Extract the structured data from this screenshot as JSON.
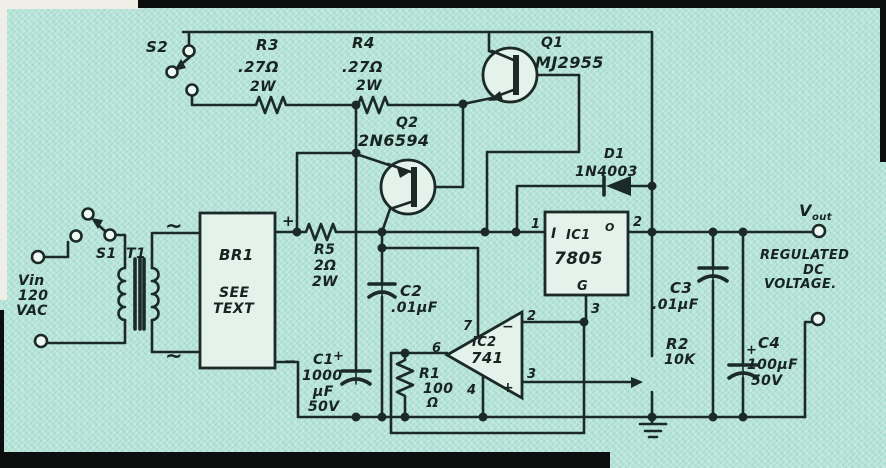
{
  "figure": {
    "type": "schematic",
    "description": "Adjustable regulated DC power supply circuit (scanned hand-drawn schematic)"
  },
  "colors": {
    "paper": "#b3e2d6",
    "ink": "#1b2a27",
    "part_fill": "#e4f2ec"
  },
  "components": {
    "s1": {
      "ref": "S1"
    },
    "s2": {
      "ref": "S2"
    },
    "t1": {
      "ref": "T1"
    },
    "br1": {
      "ref": "BR1",
      "note1": "SEE",
      "note2": "TEXT",
      "plus": "+",
      "minus": "−",
      "ac1": "~",
      "ac2": "~"
    },
    "r1": {
      "ref": "R1",
      "value": "100",
      "unit": "Ω"
    },
    "r2": {
      "ref": "R2",
      "value": "10K"
    },
    "r3": {
      "ref": "R3",
      "value": ".27Ω",
      "power": "2W"
    },
    "r4": {
      "ref": "R4",
      "value": ".27Ω",
      "power": "2W"
    },
    "r5": {
      "ref": "R5",
      "value": "2Ω",
      "power": "2W"
    },
    "c1": {
      "ref": "C1",
      "value": "1000",
      "unit": "μF",
      "voltage": "50V",
      "polarity": "+"
    },
    "c2": {
      "ref": "C2",
      "value": ".01μF"
    },
    "c3": {
      "ref": "C3",
      "value": ".01μF"
    },
    "c4": {
      "ref": "C4",
      "value": "100μF",
      "voltage": "50V",
      "polarity": "+"
    },
    "q1": {
      "ref": "Q1",
      "part": "MJ2955"
    },
    "q2": {
      "ref": "Q2",
      "part": "2N6594"
    },
    "d1": {
      "ref": "D1",
      "part": "1N4003"
    },
    "ic1": {
      "ref": "IC1",
      "part": "7805",
      "in": "I",
      "out": "O",
      "gnd": "G",
      "pin1": "1",
      "pin2": "2",
      "pin3": "3"
    },
    "ic2": {
      "ref": "IC2",
      "part": "741",
      "pin2": "2",
      "pin3": "3",
      "pin4": "4",
      "pin6": "6",
      "pin7": "7",
      "minus": "−",
      "plus": "+"
    }
  },
  "terminals": {
    "vin": {
      "label": "Vin",
      "line2": "120",
      "line3": "VAC"
    },
    "vout": {
      "label": "V",
      "sub": "out",
      "desc1": "REGULATED",
      "desc2": "DC",
      "desc3": "VOLTAGE."
    }
  }
}
